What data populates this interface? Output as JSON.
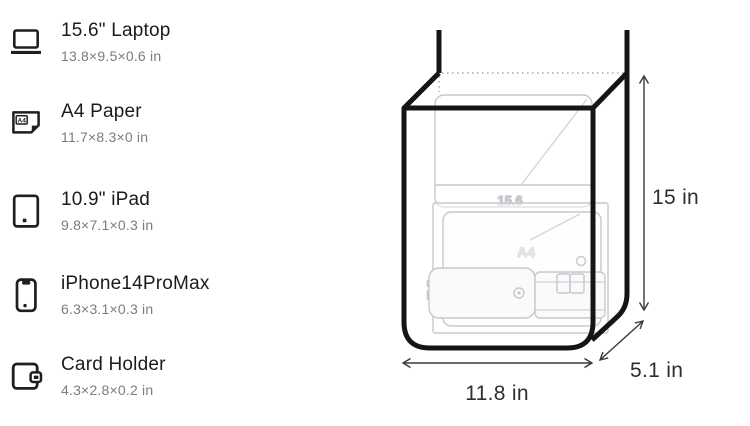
{
  "items": [
    {
      "name": "15.6\" Laptop",
      "dims": "13.8×9.5×0.6 in",
      "icon": "laptop-icon"
    },
    {
      "name": "A4 Paper",
      "dims": "11.7×8.3×0 in",
      "icon": "a4-paper-icon",
      "icon_badge": "A4"
    },
    {
      "name": "10.9\" iPad",
      "dims": "9.8×7.1×0.3 in",
      "icon": "ipad-icon"
    },
    {
      "name": "iPhone14ProMax",
      "dims": "6.3×3.1×0.3 in",
      "icon": "iphone-icon"
    },
    {
      "name": "Card Holder",
      "dims": "4.3×2.8×0.2 in",
      "icon": "card-holder-icon"
    }
  ],
  "diagram": {
    "height_label": "15 in",
    "width_label": "11.8 in",
    "depth_label": "5.1 in",
    "ghost_labels": {
      "laptop": "15.6",
      "paper": "A4"
    }
  },
  "colors": {
    "ink": "#1b1b1d",
    "subtext": "#7c7c80",
    "bag_outline": "#151515",
    "ghost": "#c6c8ce",
    "dimension_text": "#2e2e2e"
  }
}
